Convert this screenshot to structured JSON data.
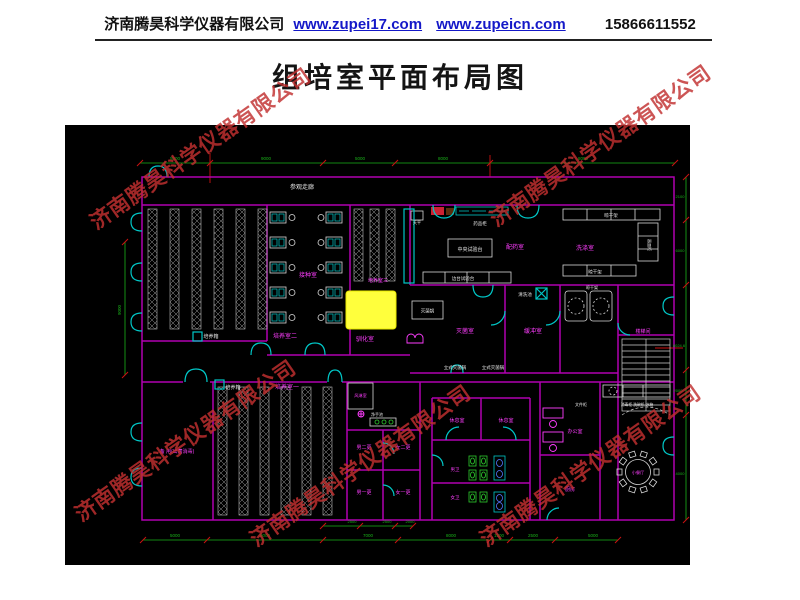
{
  "header": {
    "company": "济南腾昊科学仪器有限公司",
    "link1": "www.zupei17.com",
    "link2": "www.zupeicn.com",
    "phone": "15866611552"
  },
  "title": "组培室平面布局图",
  "watermark": {
    "text": "济南腾昊科学仪器有限公司",
    "color": "#c23030"
  },
  "plan": {
    "colors": {
      "wall": "#b000b0",
      "cyan": "#00c8c8",
      "magenta": "#ff3dff",
      "white": "#e6e6e6",
      "green": "#19b219",
      "red": "#cc1111",
      "rack": "#bbbbbb",
      "highlight": "#ffff3c",
      "background": "#000000"
    },
    "dimensions": {
      "top": [
        "5000",
        "9000",
        "5000",
        "8000",
        "8000"
      ],
      "bottom": [
        "5000",
        "9000",
        "7000",
        "8000",
        "1500",
        "2500",
        "5000"
      ],
      "bottom_inner": [
        "2500",
        "2500",
        "2000"
      ],
      "left": [
        "9000"
      ],
      "right": [
        "2100",
        "6000",
        "8024.6",
        "2000",
        "4000"
      ]
    },
    "texts": [
      {
        "t": "参观走廊",
        "x": 237,
        "y": 64,
        "c": "w",
        "s": 6
      },
      {
        "t": "培养箱",
        "x": 146,
        "y": 213,
        "c": "w",
        "s": 5
      },
      {
        "t": "培养室二",
        "x": 220,
        "y": 213,
        "c": "m",
        "s": 6
      },
      {
        "t": "培养箱",
        "x": 168,
        "y": 264,
        "c": "w",
        "s": 5
      },
      {
        "t": "培养室一",
        "x": 222,
        "y": 264,
        "c": "m",
        "s": 6
      },
      {
        "t": "备 用(出菌消毒)",
        "x": 112,
        "y": 328,
        "c": "m",
        "s": 5
      },
      {
        "t": "接种室",
        "x": 243,
        "y": 152,
        "c": "m",
        "s": 6
      },
      {
        "t": "培养室三",
        "x": 313,
        "y": 157,
        "c": "m",
        "s": 5
      },
      {
        "t": "驯化室",
        "x": 300,
        "y": 216,
        "c": "m",
        "s": 6
      },
      {
        "t": "天平",
        "x": 352,
        "y": 99,
        "c": "w",
        "s": 4
      },
      {
        "t": "药品柜",
        "x": 415,
        "y": 100,
        "c": "w",
        "s": 4.5
      },
      {
        "t": "中央试验台",
        "x": 405,
        "y": 126,
        "c": "w",
        "s": 5
      },
      {
        "t": "配药室",
        "x": 450,
        "y": 124,
        "c": "m",
        "s": 6
      },
      {
        "t": "边台试验台",
        "x": 398,
        "y": 155,
        "c": "w",
        "s": 4.5
      },
      {
        "t": "晾干架",
        "x": 546,
        "y": 92,
        "c": "w",
        "s": 4.5
      },
      {
        "t": "洗涤室",
        "x": 520,
        "y": 125,
        "c": "m",
        "s": 6
      },
      {
        "t": "晾干架",
        "x": 530,
        "y": 148.5,
        "c": "w",
        "s": 4.5
      },
      {
        "t": "器皿柜",
        "x": 583,
        "y": 120,
        "c": "w",
        "s": 4,
        "r": 90
      },
      {
        "t": "清洗池",
        "x": 460,
        "y": 171,
        "c": "w",
        "s": 4.5
      },
      {
        "t": "灭菌锅",
        "x": 362.5,
        "y": 187.5,
        "c": "w",
        "s": 4.5
      },
      {
        "t": "灭菌室",
        "x": 400,
        "y": 208,
        "c": "m",
        "s": 6
      },
      {
        "t": "缓冲室",
        "x": 468,
        "y": 208,
        "c": "m",
        "s": 6
      },
      {
        "t": "晾干架",
        "x": 527,
        "y": 164,
        "c": "w",
        "s": 4
      },
      {
        "t": "立式灭菌锅",
        "x": 390,
        "y": 244,
        "c": "w",
        "s": 4.5
      },
      {
        "t": "立式灭菌锅",
        "x": 428,
        "y": 244,
        "c": "w",
        "s": 4.5
      },
      {
        "t": "楼梯间",
        "x": 578,
        "y": 208,
        "c": "m",
        "s": 5
      },
      {
        "t": "风淋室",
        "x": 295.5,
        "y": 272,
        "c": "m",
        "s": 4.2
      },
      {
        "t": "净手池",
        "x": 312,
        "y": 291,
        "c": "w",
        "s": 4
      },
      {
        "t": "男二更",
        "x": 299,
        "y": 324,
        "c": "m",
        "s": 5
      },
      {
        "t": "女二更",
        "x": 338,
        "y": 324,
        "c": "m",
        "s": 5
      },
      {
        "t": "男一更",
        "x": 299,
        "y": 369,
        "c": "m",
        "s": 5
      },
      {
        "t": "女一更",
        "x": 338,
        "y": 369,
        "c": "m",
        "s": 5
      },
      {
        "t": "休息室",
        "x": 392,
        "y": 297,
        "c": "m",
        "s": 5
      },
      {
        "t": "休息室",
        "x": 441,
        "y": 297,
        "c": "m",
        "s": 5
      },
      {
        "t": "男卫",
        "x": 390,
        "y": 346,
        "c": "m",
        "s": 4.5
      },
      {
        "t": "女卫",
        "x": 390,
        "y": 374,
        "c": "m",
        "s": 4.5
      },
      {
        "t": "文件柜",
        "x": 516,
        "y": 281,
        "c": "w",
        "s": 4
      },
      {
        "t": "办公室",
        "x": 510,
        "y": 308,
        "c": "m",
        "s": 5
      },
      {
        "t": "厨房",
        "x": 505,
        "y": 366,
        "c": "m",
        "s": 5
      },
      {
        "t": "消毒柜 洗碗机 冰箱",
        "x": 572,
        "y": 281,
        "c": "w",
        "s": 3.8
      },
      {
        "t": "小餐厅",
        "x": 573,
        "y": 349,
        "c": "m",
        "s": 4.2
      },
      {
        "t": "5000",
        "x": 110,
        "y": 35,
        "c": "g",
        "s": 4.5
      },
      {
        "t": "9000",
        "x": 201,
        "y": 35,
        "c": "g",
        "s": 4.5
      },
      {
        "t": "5000",
        "x": 295,
        "y": 35,
        "c": "g",
        "s": 4.5
      },
      {
        "t": "8000",
        "x": 378,
        "y": 35,
        "c": "g",
        "s": 4.5
      },
      {
        "t": "8000",
        "x": 518,
        "y": 35,
        "c": "g",
        "s": 4.5
      },
      {
        "t": "5000",
        "x": 110,
        "y": 412,
        "c": "g",
        "s": 4.5
      },
      {
        "t": "9000",
        "x": 200,
        "y": 412,
        "c": "g",
        "s": 4.5
      },
      {
        "t": "7000",
        "x": 303,
        "y": 412,
        "c": "g",
        "s": 4.5
      },
      {
        "t": "8000",
        "x": 386,
        "y": 412,
        "c": "g",
        "s": 4.5
      },
      {
        "t": "1500",
        "x": 434,
        "y": 412,
        "c": "g",
        "s": 4.5
      },
      {
        "t": "2500",
        "x": 468,
        "y": 412,
        "c": "g",
        "s": 4.5
      },
      {
        "t": "5000",
        "x": 528,
        "y": 412,
        "c": "g",
        "s": 4.5
      },
      {
        "t": "2500",
        "x": 287,
        "y": 398,
        "c": "g",
        "s": 4
      },
      {
        "t": "2500",
        "x": 322,
        "y": 398,
        "c": "g",
        "s": 4
      },
      {
        "t": "2000",
        "x": 345,
        "y": 398,
        "c": "g",
        "s": 4
      },
      {
        "t": "9000",
        "x": 56,
        "y": 185,
        "c": "g",
        "s": 4.5,
        "r": -90
      },
      {
        "t": "2100",
        "x": 615,
        "y": 73,
        "c": "g",
        "s": 4
      },
      {
        "t": "6000",
        "x": 615,
        "y": 127,
        "c": "g",
        "s": 4
      },
      {
        "t": "8024.6",
        "x": 614,
        "y": 222,
        "c": "g",
        "s": 4
      },
      {
        "t": "2000",
        "x": 613,
        "y": 267,
        "c": "g",
        "s": 4
      },
      {
        "t": "4000",
        "x": 615,
        "y": 350,
        "c": "g",
        "s": 4
      }
    ]
  }
}
